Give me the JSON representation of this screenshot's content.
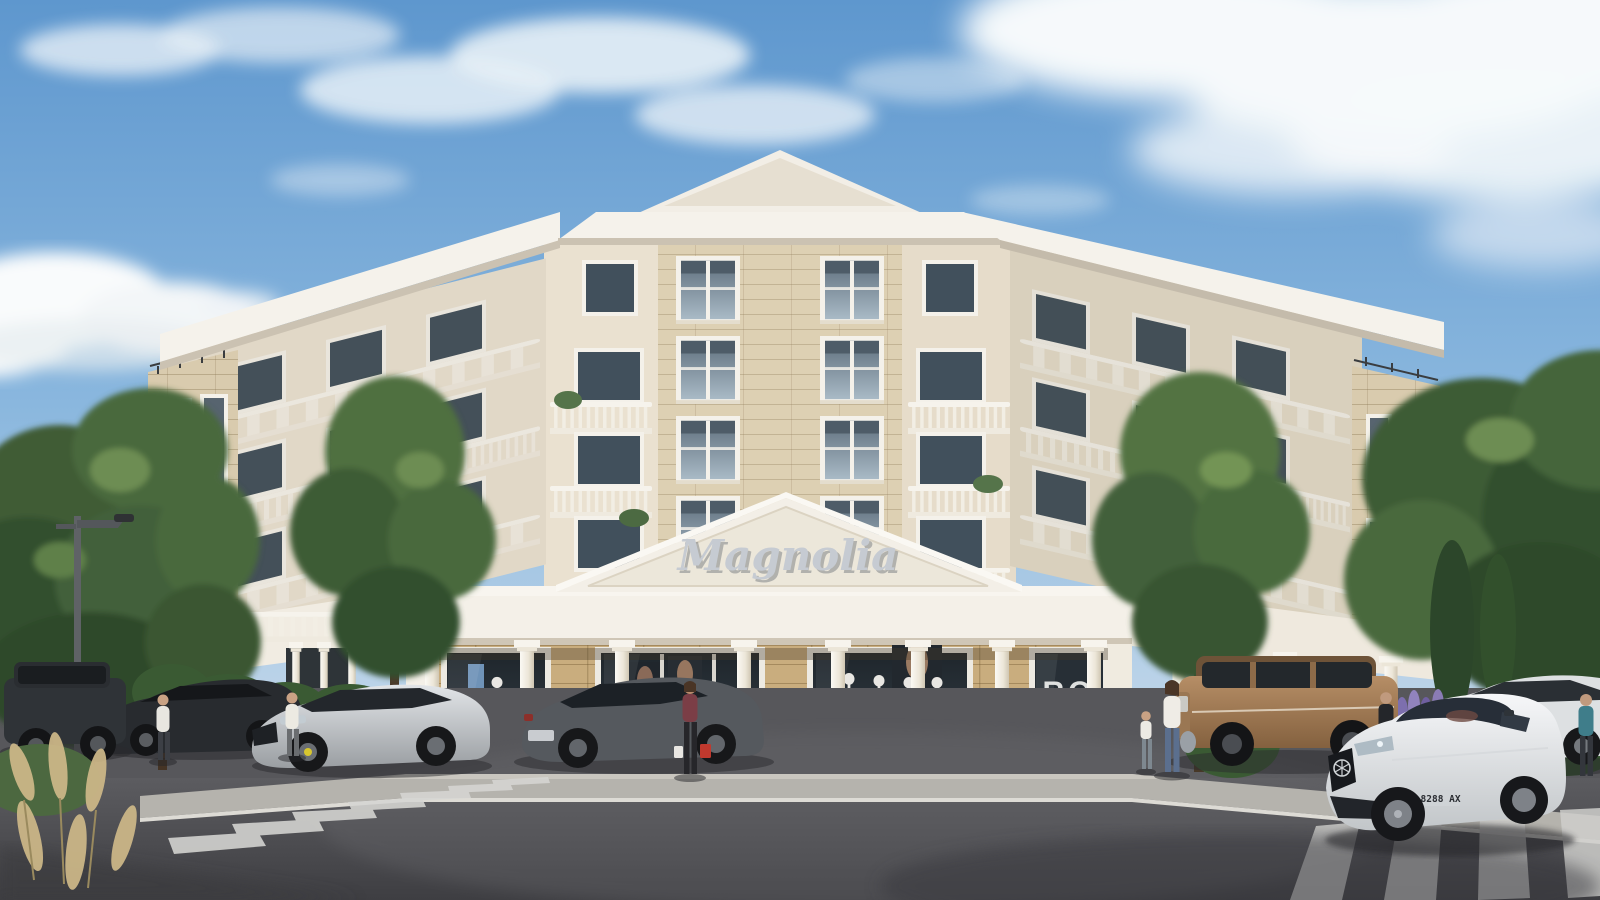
{
  "scene": {
    "title": "Magnolia residential building — architectural render",
    "description": "Sunny 3D exterior rendering of a five-storey classical-style corner apartment building with cream stucco and beige stone cladding, white cornices and balustraded balconies, a triangular entrance pediment bearing the building name, a ground-floor clothing boutique with mannequins in the windows, a street with two zebra crosswalks, parked cars, pedestrians and a white luxury sedan driving past.",
    "sky": {
      "weather": "sunny, blue sky with scattered white clouds"
    },
    "building": {
      "name_sign": "Magnolia",
      "floors": 5,
      "features": [
        "triangular roof pediment",
        "white cornice bands",
        "balustraded balconies",
        "wrought-iron balcony sections",
        "stone-clad end towers",
        "ground-floor colonnade of white columns"
      ]
    },
    "boutique": {
      "kind": "clothing store",
      "door_letters_line1": "RO",
      "door_letters_line2": "TA",
      "mannequins": 5,
      "posters": 4,
      "shopper_bags": [
        "red",
        "white"
      ]
    },
    "street": {
      "crosswalks": 2,
      "lamp_posts": 1,
      "surfaces": [
        "asphalt road",
        "light concrete sidewalk"
      ]
    },
    "vehicles": [
      {
        "label": "dark SUV parked left",
        "color": "#2f3337"
      },
      {
        "label": "dark sedan parked left",
        "color": "#282b2f"
      },
      {
        "label": "silver sports sedan",
        "color": "#c3c7cb"
      },
      {
        "label": "grey sedan",
        "color": "#55595e"
      },
      {
        "label": "bronze SUV parked right",
        "color": "#a8825f"
      },
      {
        "label": "white luxury sedan crossing",
        "color": "#eceef0",
        "license_plate": "CB 8288 AX"
      },
      {
        "label": "white SUV far right",
        "color": "#dde0e2"
      }
    ],
    "people": [
      {
        "label": "pedestrian by parked cars (left)"
      },
      {
        "label": "second pedestrian by parked cars"
      },
      {
        "label": "shopper leaving boutique with bags"
      },
      {
        "label": "mother walking with child"
      },
      {
        "label": "man in black t-shirt and white shorts"
      },
      {
        "label": "two women walking (right)"
      },
      {
        "label": "man at right edge"
      }
    ],
    "vegetation": [
      "tall deciduous trees left",
      "tree in front of facade",
      "tree cluster right",
      "cypresses",
      "lavender clumps",
      "clipped round bushes",
      "pampas grass foreground"
    ],
    "palette": {
      "sky_top": "#5e97ce",
      "sky_horizon": "#d3e2ee",
      "stucco": "#ece4d4",
      "stone_upper": "#d9cbae",
      "stone_gold": "#c9ad7e",
      "trim_white": "#f5f2eb",
      "road": "#4c4c50",
      "sidewalk": "#b5b3ad",
      "foliage": "#49693c"
    }
  }
}
